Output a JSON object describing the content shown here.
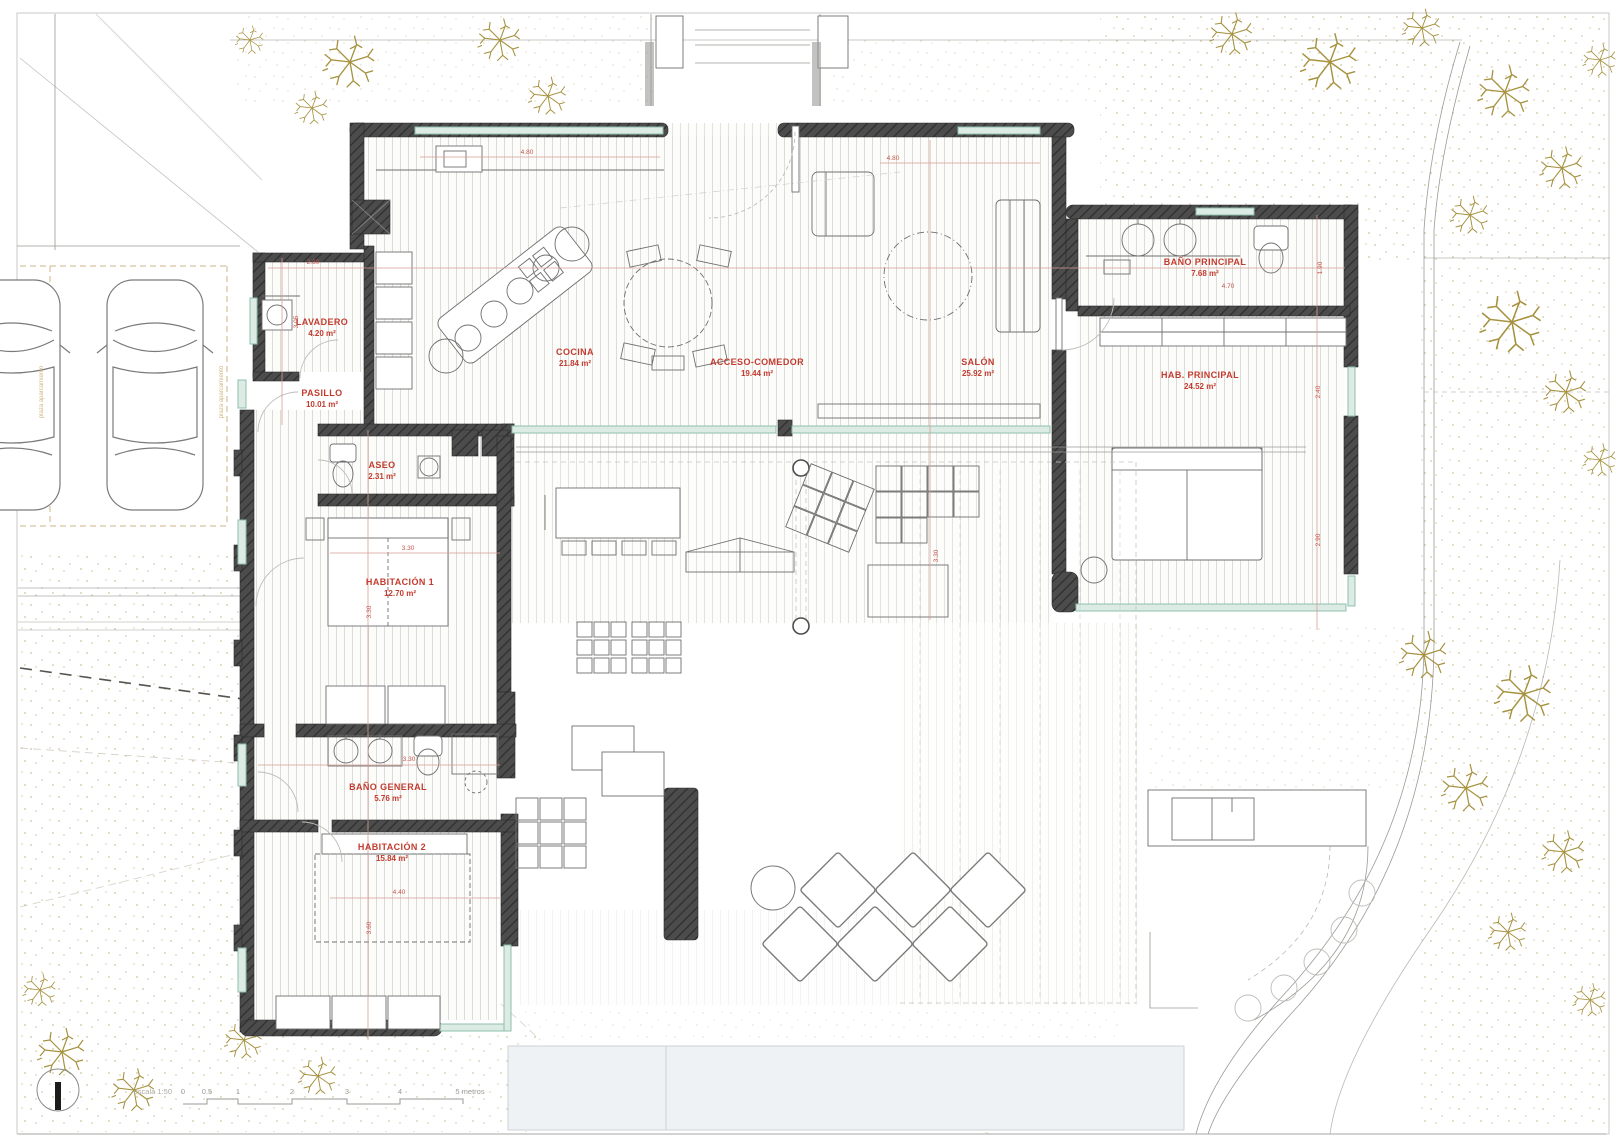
{
  "drawing": {
    "kind": "residential floor plan with site landscaping",
    "language": "Spanish"
  },
  "rooms": [
    {
      "name": "LAVADERO",
      "area": "4.20 m²"
    },
    {
      "name": "PASILLO",
      "area": "10.01 m²"
    },
    {
      "name": "COCINA",
      "area": "21.84 m²"
    },
    {
      "name": "ACCESO-COMEDOR",
      "area": "19.44 m²"
    },
    {
      "name": "SALÓN",
      "area": "25.92 m²"
    },
    {
      "name": "BAÑO PRINCIPAL",
      "area": "7.68 m²"
    },
    {
      "name": "HAB. PRINCIPAL",
      "area": "24.52 m²"
    },
    {
      "name": "ASEO",
      "area": "2.31 m²"
    },
    {
      "name": "HABITACIÓN 1",
      "area": "12.70 m²"
    },
    {
      "name": "BAÑO GENERAL",
      "area": "5.76 m²"
    },
    {
      "name": "HABITACIÓN 2",
      "area": "15.84 m²"
    }
  ],
  "dimensions": [
    "4.80",
    "4.80",
    "2.30",
    "4.70",
    "3.30",
    "3.30",
    "4.40",
    "1.90",
    "2.40",
    "2.90",
    "3.05",
    "3.30",
    "3.60",
    "3.30"
  ],
  "scale_bar": {
    "label": "escala 1:50",
    "ticks": [
      "0",
      "0.5",
      "1",
      "2",
      "3",
      "4",
      "5 metros"
    ]
  },
  "annotations": {
    "parking": "plaza aparcamiento"
  },
  "colors": {
    "wall": "#474747",
    "room_label_red": "#c23b2e",
    "glass_teal": "#8fbfae",
    "tree_gold": "#a6923f",
    "sand_dots": "#c9bc92",
    "pool_blue": "#eef2f5"
  }
}
